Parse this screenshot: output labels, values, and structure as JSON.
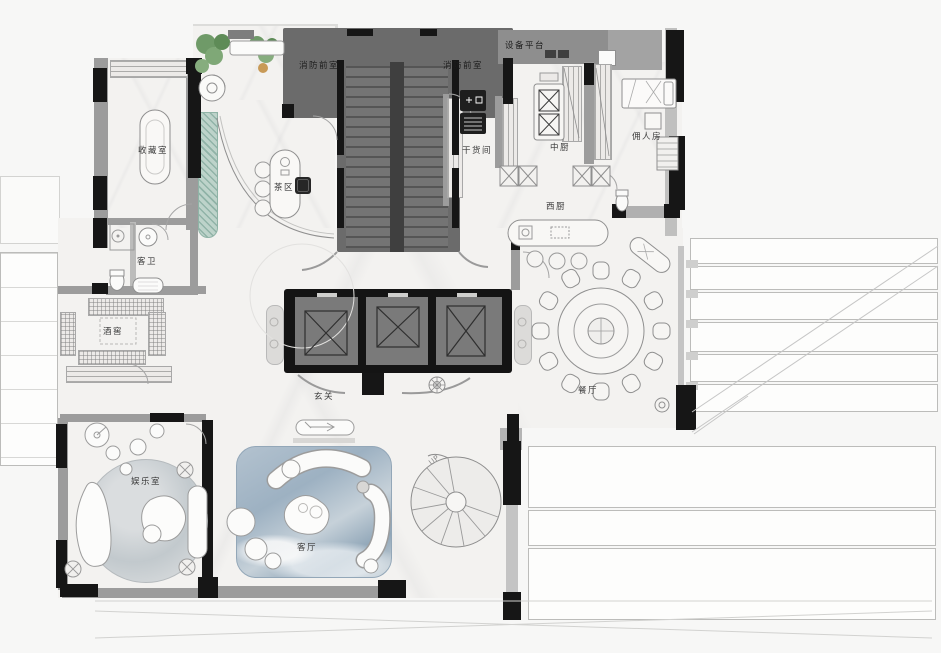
{
  "plan": {
    "type": "residential-floor-plan",
    "style": "rendered color plan, top view"
  },
  "labels": {
    "fire_lobby_left": "消防前室",
    "fire_lobby_right": "消防前室",
    "equipment_platform": "设备平台",
    "dry_storage": "干货间",
    "chinese_kitchen": "中厨",
    "western_kitchen": "西厨",
    "maid_room": "佣人房",
    "collection_room": "收藏室",
    "tea_area": "茶区",
    "guest_bath": "客卫",
    "wine_cellar": "酒窖",
    "foyer": "玄关",
    "dining_room": "餐厅",
    "entertainment_room": "娱乐室",
    "living_room": "客厅",
    "stair_direction": "UP"
  },
  "colors": {
    "core_gray": "#6b6b6b",
    "wall_black": "#161616",
    "wall_gray": "#9c9c9c",
    "floor": "#f3f2f0",
    "rug_blue": "#9fb2c2",
    "rug_gray": "#c8cdd0",
    "glass_teal": "#aec9c0",
    "plant_green": "#6f9a68"
  }
}
